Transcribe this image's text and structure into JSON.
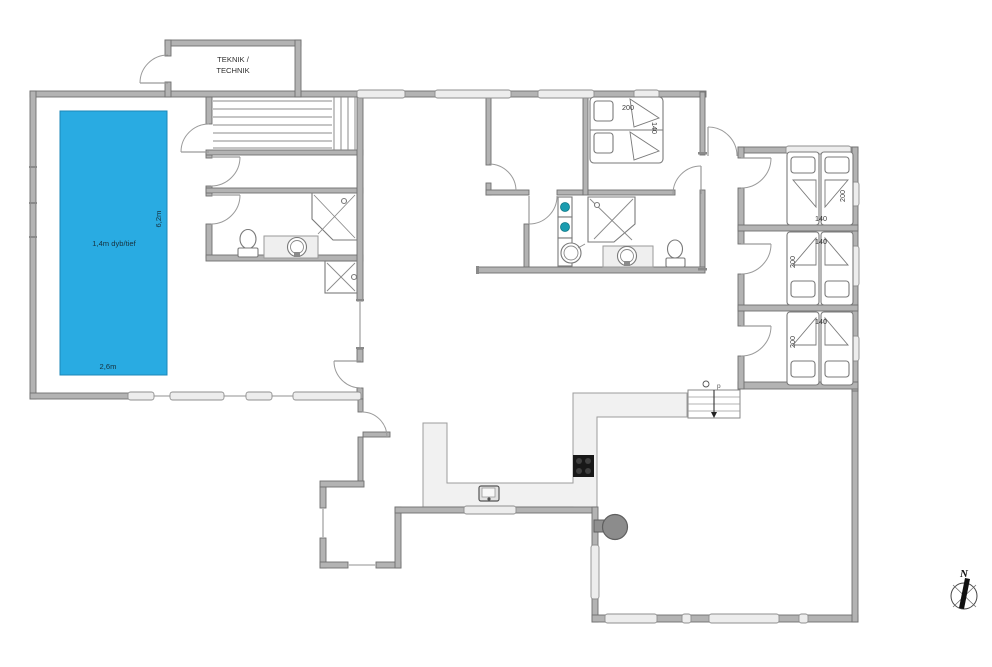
{
  "colors": {
    "pool": "#29abe2",
    "pool_border": "#1b87b8",
    "washer_drum": "#1a9cb0"
  },
  "labels": {
    "teknik_line1": "TEKNIK /",
    "teknik_line2": "TECHNIK",
    "pool_depth": "1,4m dyb/tief",
    "pool_length": "6,2m",
    "pool_width": "2,6m",
    "compass_north": "N",
    "stair_mark_letter": "p"
  },
  "beds": {
    "double": {
      "length": "200",
      "width": "140"
    },
    "east1": {
      "length": "200",
      "width": "140"
    },
    "east2": {
      "length": "140",
      "width": "200"
    },
    "east3": {
      "length": "140",
      "width": "200"
    }
  }
}
